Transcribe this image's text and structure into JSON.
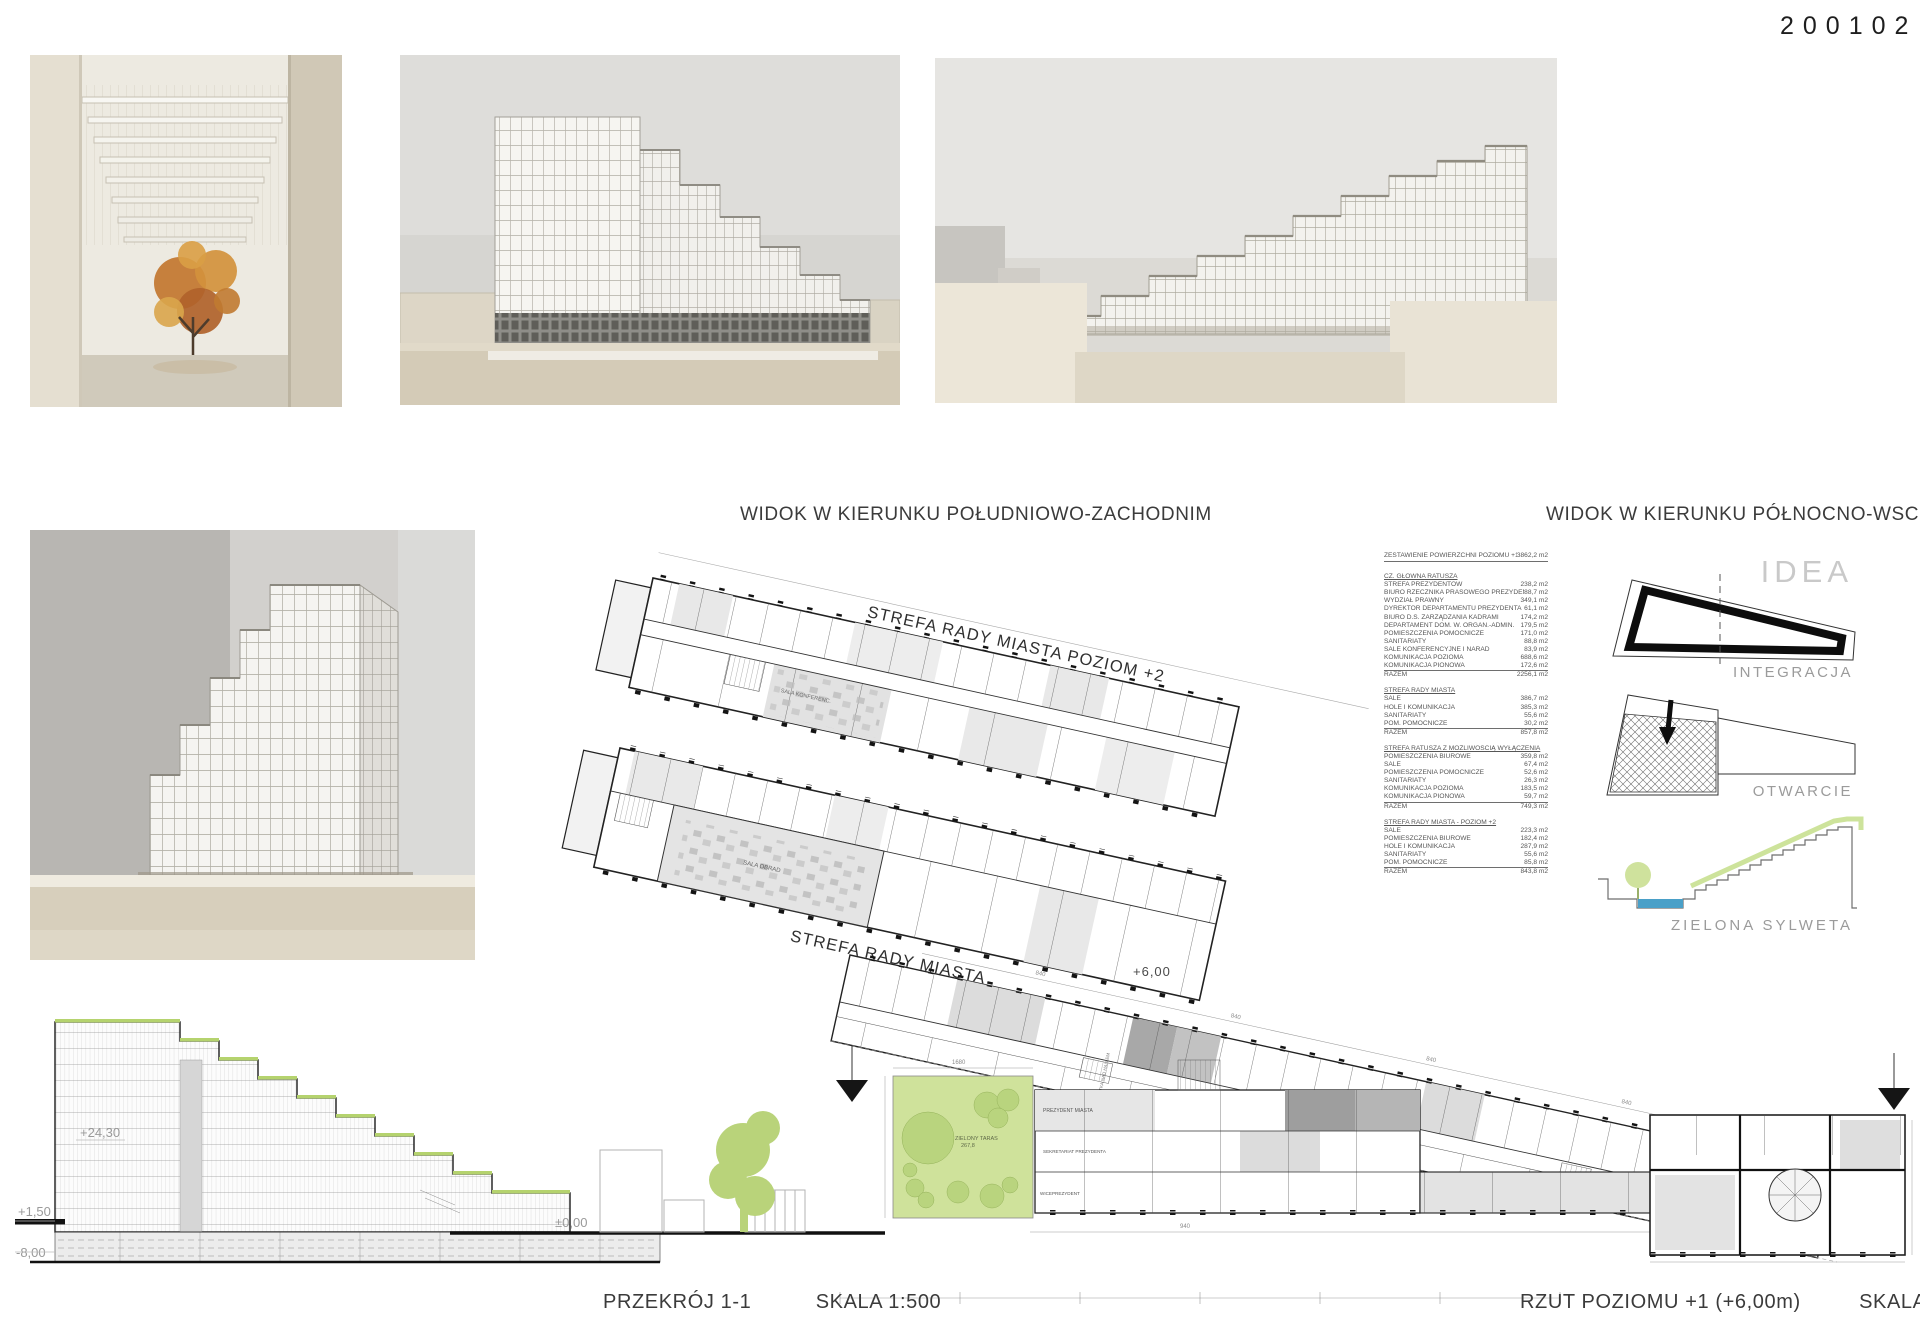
{
  "board": {
    "number": "200102"
  },
  "captions": {
    "photo_sw": "WIDOK W KIERUNKU POŁUDNIOWO-ZACHODNIM",
    "photo_ne": "WIDOK W KIERUNKU PÓŁNOCNO-WSCHODNIM",
    "section_title": "PRZEKRÓJ 1-1",
    "section_scale": "SKALA 1:500",
    "plan_title": "RZUT POZIOMU +1 (+6,00m)",
    "plan_scale": "SKALA 1:250"
  },
  "plan": {
    "strip2": "STREFA RADY MIASTA POZIOM +2",
    "strip1": "STREFA RADY MIASTA",
    "level": "+6,00",
    "terrace": "ZIELONY TARAS",
    "terrace_area": "267,8",
    "room_labels": [
      "PREZYDENT MIASTA",
      "SEKRETARIAT PREZYDENTA",
      "WICEPREZYDENT",
      "SALA OBRAD",
      "SALA KONFERENC.",
      "PUSTKA NAD HALLEM"
    ],
    "dims": [
      "1680",
      "840",
      "840",
      "840",
      "840",
      "940"
    ]
  },
  "section": {
    "levels": {
      "top": "+24,30",
      "plaza": "+1,50",
      "ground": "±0,00",
      "basement": "-8,00"
    }
  },
  "diagrams": {
    "title": "IDEA",
    "integration": "INTEGRACJA",
    "opening": "OTWARCIE",
    "green": "ZIELONA SYLWETA"
  },
  "area_table": {
    "header": {
      "label": "ZESTAWIENIE POWIERZCHNI POZIOMU +1",
      "value": "3862,2 m2"
    },
    "total_label": "RAZEM",
    "sections": [
      {
        "title": "CZ. GŁÓWNA RATUSZA",
        "rows": [
          [
            "STREFA PREZYDENTÓW",
            "238,2 m2"
          ],
          [
            "BIURO RZECZNIKA PRASOWEGO PREZYDENTA",
            "88,7 m2"
          ],
          [
            "WYDZIAŁ PRAWNY",
            "349,1 m2"
          ],
          [
            "DYREKTOR DEPARTAMENTU PREZYDENTA",
            "61,1 m2"
          ],
          [
            "BIURO D.S. ZARZĄDZANIA KADRAMI",
            "174,2 m2"
          ],
          [
            "DEPARTAMENT DOM. W. ORGAN.-ADMIN.",
            "179,5 m2"
          ],
          [
            "POMIESZCZENIA POMOCNICZE",
            "171,0 m2"
          ],
          [
            "SANITARIATY",
            "88,8 m2"
          ],
          [
            "SALE KONFERENCYJNE I NARAD",
            "83,9 m2"
          ],
          [
            "KOMUNIKACJA POZIOMA",
            "688,6 m2"
          ],
          [
            "KOMUNIKACJA PIONOWA",
            "172,6 m2"
          ]
        ],
        "total": "2256,1 m2"
      },
      {
        "title": "STREFA RADY MIASTA",
        "rows": [
          [
            "SALE",
            "386,7 m2"
          ],
          [
            "HOLE I KOMUNIKACJA",
            "385,3 m2"
          ],
          [
            "SANITARIATY",
            "55,6 m2"
          ],
          [
            "POM. POMOCNICZE",
            "30,2 m2"
          ]
        ],
        "total": "857,8 m2"
      },
      {
        "title": "STREFA RATUSZA Z MOŻLIWOŚCIĄ WYŁĄCZENIA",
        "rows": [
          [
            "POMIESZCZENIA BIUROWE",
            "359,8 m2"
          ],
          [
            "SALE",
            "67,4 m2"
          ],
          [
            "POMIESZCZENIA POMOCNICZE",
            "52,6 m2"
          ],
          [
            "SANITARIATY",
            "26,3 m2"
          ],
          [
            "KOMUNIKACJA POZIOMA",
            "183,5 m2"
          ],
          [
            "KOMUNIKACJA PIONOWA",
            "59,7 m2"
          ]
        ],
        "total": "749,3 m2"
      },
      {
        "title": "STREFA RADY MIASTA - POZIOM +2",
        "rows": [
          [
            "SALE",
            "223,3 m2"
          ],
          [
            "POMIESZCZENIA BIUROWE",
            "182,4 m2"
          ],
          [
            "HOLE I KOMUNIKACJA",
            "287,9 m2"
          ],
          [
            "SANITARIATY",
            "55,6 m2"
          ],
          [
            "POM. POMOCNICZE",
            "85,8 m2"
          ]
        ],
        "total": "843,8 m2"
      }
    ]
  },
  "colors": {
    "green": "#c3d98b",
    "water": "#4aa0c8",
    "accent_dark": "#111111"
  }
}
